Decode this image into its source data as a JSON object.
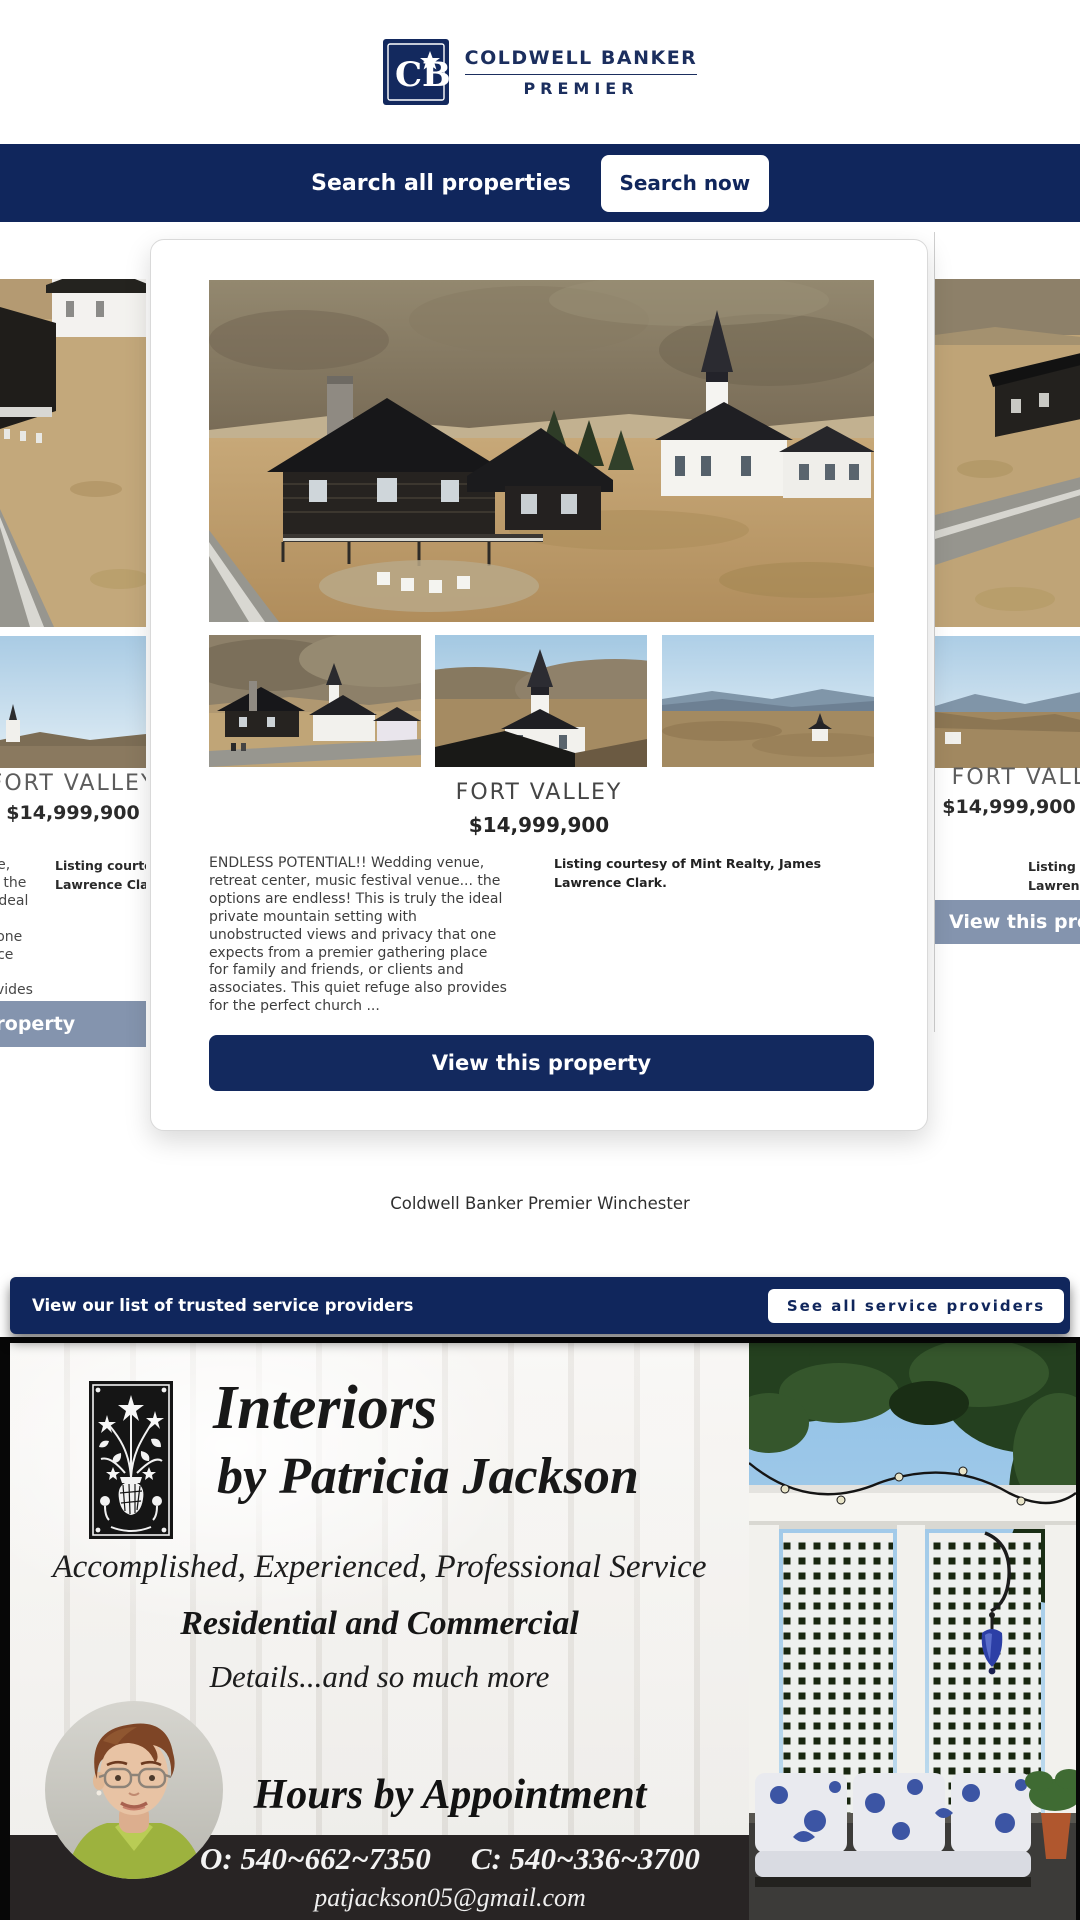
{
  "brand": {
    "monogram": "CB",
    "name_line1": "COLDWELL BANKER",
    "name_line2": "PREMIER"
  },
  "search_bar": {
    "label": "Search all properties",
    "button_label": "Search now"
  },
  "listing": {
    "title": "FORT VALLEY",
    "price": "$14,999,900",
    "description": "ENDLESS POTENTIAL!! Wedding venue, retreat center, music festival venue... the options are endless! This is truly the ideal private mountain setting with unobstructed views and privacy that one expects from a premier gathering place for family and friends, or clients and associates. This quiet refuge also provides for the perfect church ...",
    "courtesy": "Listing courtesy of Mint Realty, James Lawrence Clark.",
    "cta_label": "View this property"
  },
  "office_name": "Coldwell Banker Premier Winchester",
  "service_bar": {
    "label": "View our list of trusted service providers",
    "button_label": "See all service providers"
  },
  "ad": {
    "brand_line1": "Interiors",
    "brand_line2": "by Patricia Jackson",
    "tagline": "Accomplished, Experienced, Professional Service",
    "subline": "Residential and Commercial",
    "detail_line": "Details...and so much more",
    "hours_line": "Hours by Appointment",
    "office_phone": "O: 540~662~7350",
    "cell_phone": "C: 540~336~3700",
    "email": "patjackson05@gmail.com"
  },
  "colors": {
    "navy": "#10265c",
    "slate_button": "#8494ae",
    "ad_bar": "#282424"
  }
}
